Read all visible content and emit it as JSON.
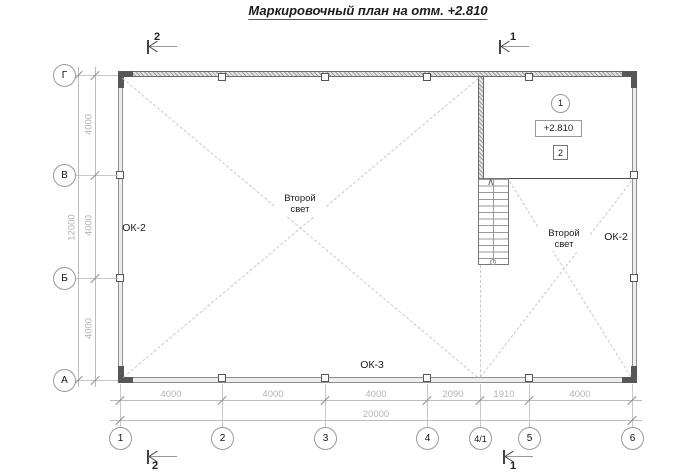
{
  "title": "Маркировочный план на отм. +2.810",
  "axes": {
    "rows": [
      "Г",
      "В",
      "Б",
      "А"
    ],
    "cols": [
      "1",
      "2",
      "3",
      "4",
      "4/1",
      "5",
      "6"
    ]
  },
  "dims": {
    "v_inner": [
      "4000",
      "4000",
      "4000"
    ],
    "v_outer": "12000",
    "h_inner": [
      "4000",
      "4000",
      "4000",
      "2090",
      "1910",
      "4000"
    ],
    "h_outer": "20000"
  },
  "labels": {
    "ok2_left": "ОК-2",
    "ok2_right": "ОК-2",
    "ok3": "ОК-3",
    "second_light_left": "Второй свет",
    "second_light_right": "Второй свет",
    "elevation": "+2.810",
    "node_circle": "1",
    "node_square": "2"
  },
  "section_marks": {
    "top_left": "2",
    "top_right": "1",
    "bottom_left": "2",
    "bottom_right": "1"
  },
  "icons": {
    "stairs_up": "∧"
  },
  "colors": {
    "dim_text": "#b4b4b4",
    "wall_fill": "#ededed",
    "line": "#9a9a9a"
  }
}
